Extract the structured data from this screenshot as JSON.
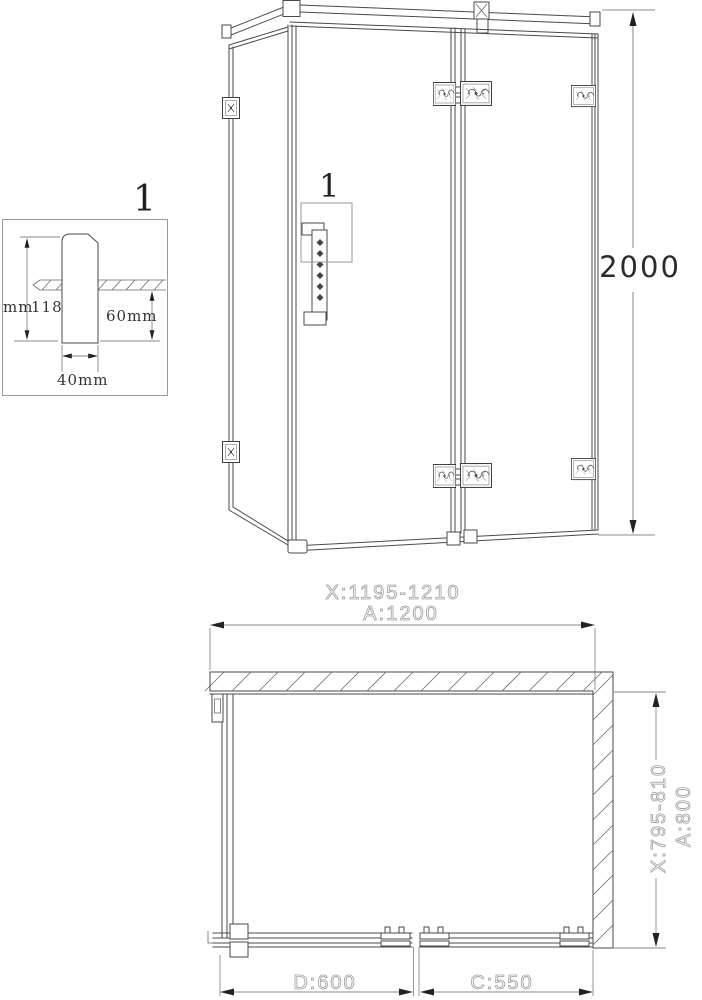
{
  "colors": {
    "line": "#4a4a4a",
    "dimension_line": "#8a8a8a",
    "cad_text": "#9e9e9e",
    "dark_text": "#2b2b2b"
  },
  "detail_view": {
    "callout": "1",
    "total_height_prefix": "mm",
    "total_height_value": "118",
    "protrusion": "60mm",
    "width": "40mm"
  },
  "elevation_view": {
    "callout": "1",
    "height": "2000"
  },
  "plan_view": {
    "width_range": "X:1195-1210",
    "width": "A:1200",
    "depth_range": "X:795-810",
    "depth": "A:800",
    "fixed_panel": "D:600",
    "door_panel": "C:550"
  }
}
